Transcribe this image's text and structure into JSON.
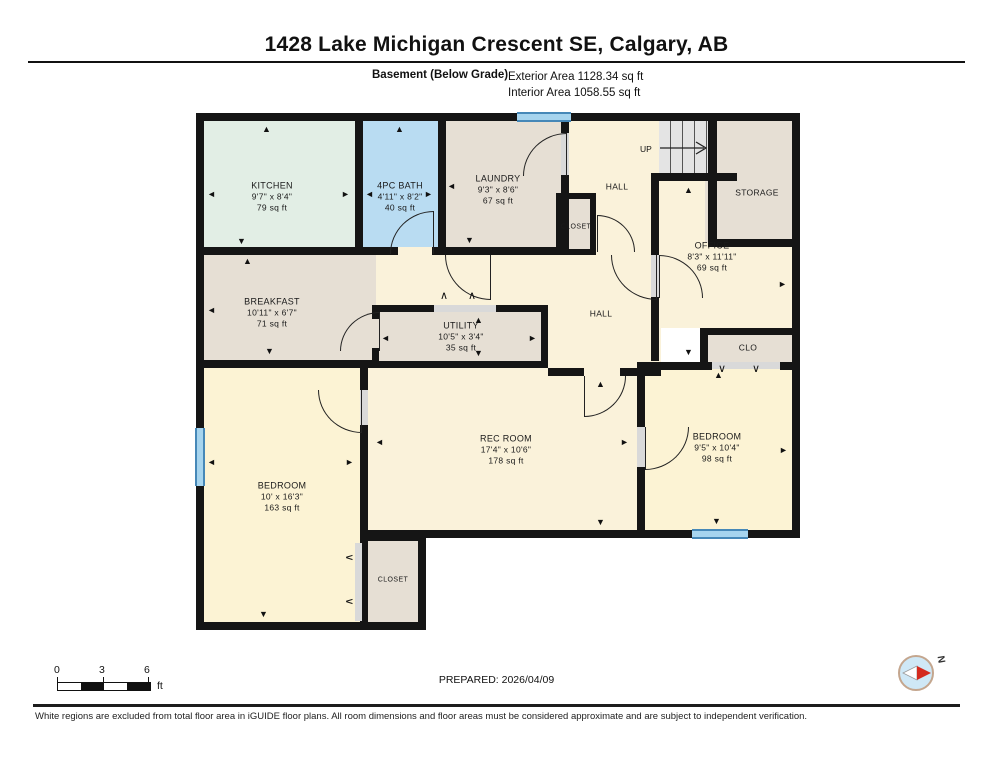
{
  "header": {
    "title": "1428 Lake Michigan Crescent SE, Calgary, AB",
    "floor_label": "Basement (Below Grade)",
    "exterior_area": "Exterior Area 1128.34 sq ft",
    "interior_area": "Interior Area 1058.55 sq ft"
  },
  "rooms": {
    "kitchen": {
      "name": "KITCHEN",
      "dims": "9'7\" x 8'4\"",
      "area": "79 sq ft"
    },
    "bath": {
      "name": "4PC BATH",
      "dims": "4'11\" x 8'2\"",
      "area": "40 sq ft"
    },
    "laundry": {
      "name": "LAUNDRY",
      "dims": "9'3\" x 8'6\"",
      "area": "67 sq ft"
    },
    "closet_top": {
      "name": "CLOSET"
    },
    "hall_top": {
      "name": "HALL"
    },
    "stairs": {
      "name": "UP"
    },
    "storage": {
      "name": "STORAGE"
    },
    "office": {
      "name": "OFFICE",
      "dims": "8'3\" x 11'11\"",
      "area": "69 sq ft"
    },
    "clo": {
      "name": "CLO"
    },
    "breakfast": {
      "name": "BREAKFAST",
      "dims": "10'11\" x 6'7\"",
      "area": "71 sq ft"
    },
    "utility": {
      "name": "UTILITY",
      "dims": "10'5\" x 3'4\"",
      "area": "35 sq ft"
    },
    "hall_mid": {
      "name": "HALL"
    },
    "rec_room": {
      "name": "REC ROOM",
      "dims": "17'4\" x 10'6\"",
      "area": "178 sq ft"
    },
    "bedroom_left": {
      "name": "BEDROOM",
      "dims": "10' x 16'3\"",
      "area": "163 sq ft"
    },
    "bedroom_right": {
      "name": "BEDROOM",
      "dims": "9'5\" x 10'4\"",
      "area": "98 sq ft"
    },
    "closet_bottom": {
      "name": "CLOSET"
    }
  },
  "footer": {
    "scale_ticks": [
      "0",
      "3",
      "6"
    ],
    "scale_unit": "ft",
    "prepared": "PREPARED: 2026/04/09",
    "compass_label": "N",
    "disclaimer": "White regions are excluded from total floor area in iGUIDE floor plans. All room dimensions and floor areas must be considered approximate and are subject to independent verification."
  }
}
